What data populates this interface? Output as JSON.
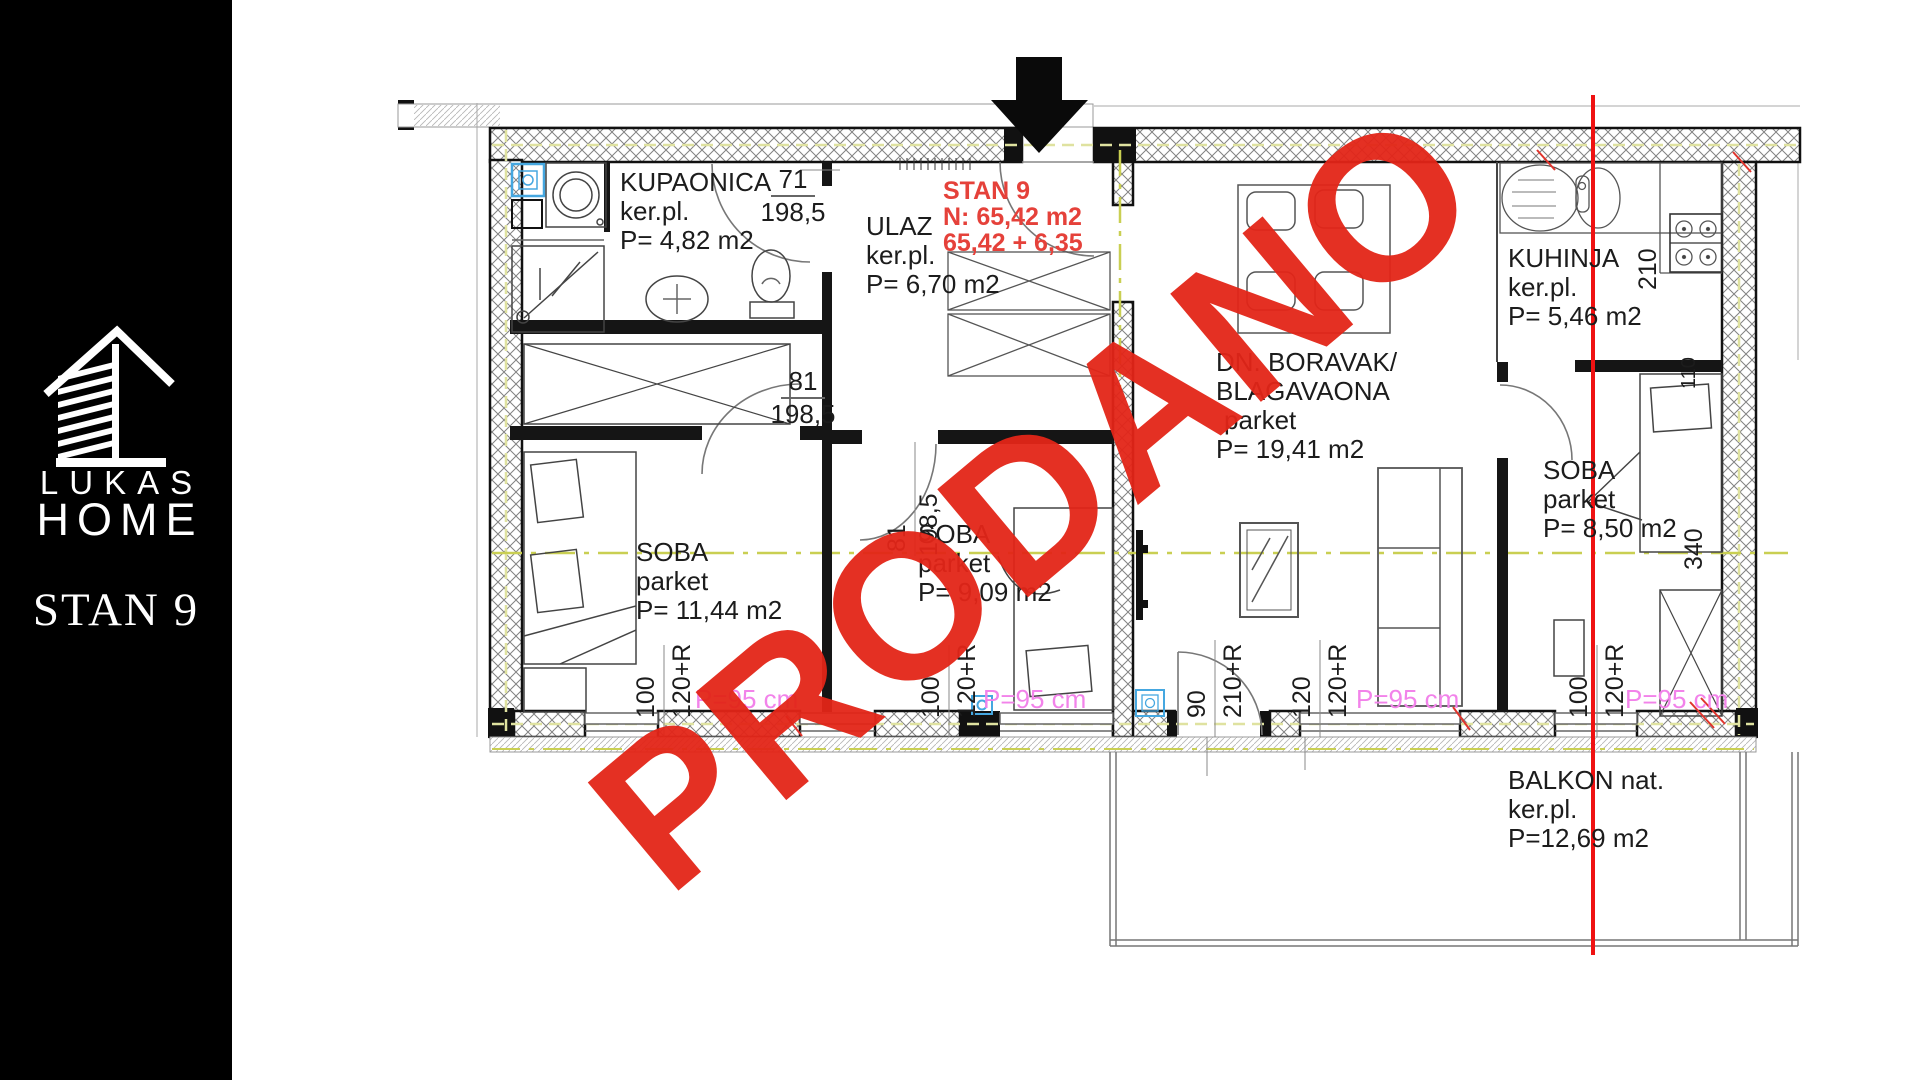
{
  "sidebar": {
    "brand_top": "LUKAS",
    "brand_bottom": "HOME",
    "unit_label": "STAN 9"
  },
  "watermark": {
    "text": "PRODANO",
    "color": "#e32518"
  },
  "unit": {
    "title": "STAN 9",
    "net_area": "N: 65,42 m2",
    "total_area": "65,42 + 6,35",
    "color": "#e5413a"
  },
  "rooms": {
    "kupaonica": {
      "name": "KUPAONICA",
      "floor": "ker.pl.",
      "area": "P= 4,82 m2"
    },
    "ulaz": {
      "name": "ULAZ",
      "floor": "ker.pl.",
      "area": "P= 6,70 m2"
    },
    "soba1": {
      "name": "SOBA",
      "floor": "parket",
      "area": "P= 11,44 m2"
    },
    "soba2": {
      "name": "SOBA",
      "floor": "parket",
      "area": "P= 9,09 m2"
    },
    "boravak": {
      "name_line1": "DN. BORAVAK/",
      "name_line2": "BLAGAVAONA",
      "floor": "parket",
      "area": "P= 19,41 m2"
    },
    "kuhinja": {
      "name": "KUHINJA",
      "floor": "ker.pl.",
      "area": "P= 5,46 m2"
    },
    "soba3": {
      "name": "SOBA",
      "floor": "parket",
      "area": "P= 8,50 m2"
    },
    "balkon": {
      "name": "BALKON nat.",
      "floor": "ker.pl.",
      "area": "P=12,69 m2"
    }
  },
  "dims": {
    "door_bath_w": "71",
    "door_bath_h": "198,5",
    "door_soba1_w": "81",
    "door_soba1_h": "198,5",
    "door_soba2_w": "81",
    "door_soba2_h": "198,5",
    "kitchen_depth": "210",
    "niche": "110",
    "soba3_length": "340",
    "win_soba1_a": "100",
    "win_soba1_b": "120+R",
    "win_soba2_a": "100",
    "win_soba2_b": "120+R",
    "door_balkon_a": "90",
    "door_balkon_b": "210+R",
    "win_living_a": "120",
    "win_living_b": "120+R",
    "win_soba3_a": "100",
    "win_soba3_b": "120+R",
    "parapet": "P=95 cm",
    "parapet_color": "#f283ea"
  }
}
